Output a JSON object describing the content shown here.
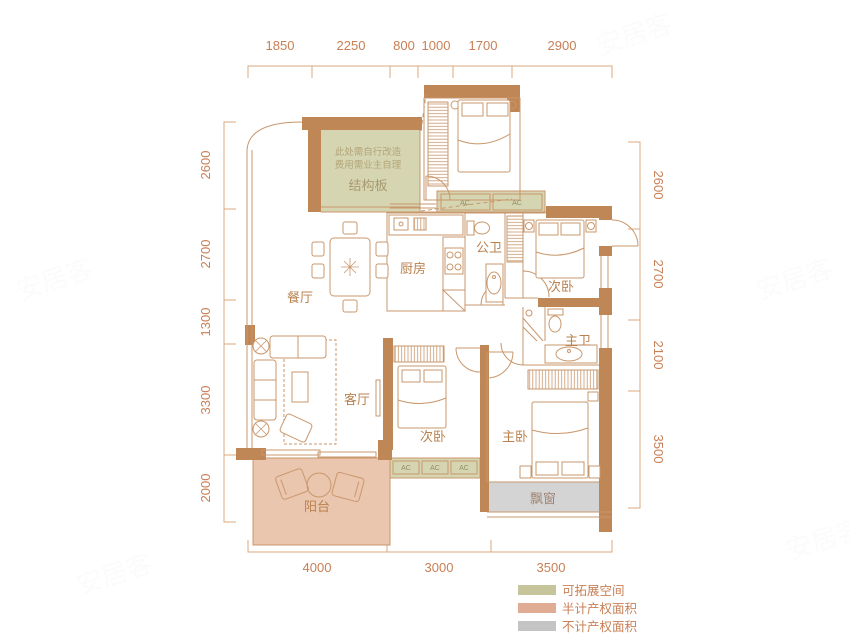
{
  "plan": {
    "rooms": {
      "dining": "餐厅",
      "kitchen": "厨房",
      "public_bath": "公卫",
      "bedroom_top": "次卧",
      "living": "客厅",
      "bedroom_mid": "次卧",
      "master_bedroom": "主卧",
      "master_bath": "主卫",
      "balcony": "阳台",
      "bay_window": "飘窗",
      "structure_slab": "结构板"
    },
    "structure_note_line1": "此处需自行改造",
    "structure_note_line2": "费用需业主自理",
    "ac_label": "AC"
  },
  "dimensions": {
    "top": [
      "1850",
      "2250",
      "800",
      "1000",
      "1700",
      "2900"
    ],
    "left": [
      "2600",
      "2700",
      "1300",
      "3300",
      "2000"
    ],
    "right": [
      "2600",
      "2700",
      "2100",
      "3500"
    ],
    "bottom": [
      "4000",
      "3000",
      "3500"
    ]
  },
  "legend": {
    "items": [
      {
        "label": "可拓展空间",
        "color": "#c6c49b"
      },
      {
        "label": "半计产权面积",
        "color": "#e0ac93"
      },
      {
        "label": "不计产权面积",
        "color": "#c4c4c4"
      }
    ]
  },
  "colors": {
    "wall": "#bf8656",
    "thin_line": "#c9976c",
    "expand_fill": "#d6d5b2",
    "balcony_fill": "#eac6ae",
    "bay_fill": "#d4d4d4"
  },
  "watermark": "安居客"
}
